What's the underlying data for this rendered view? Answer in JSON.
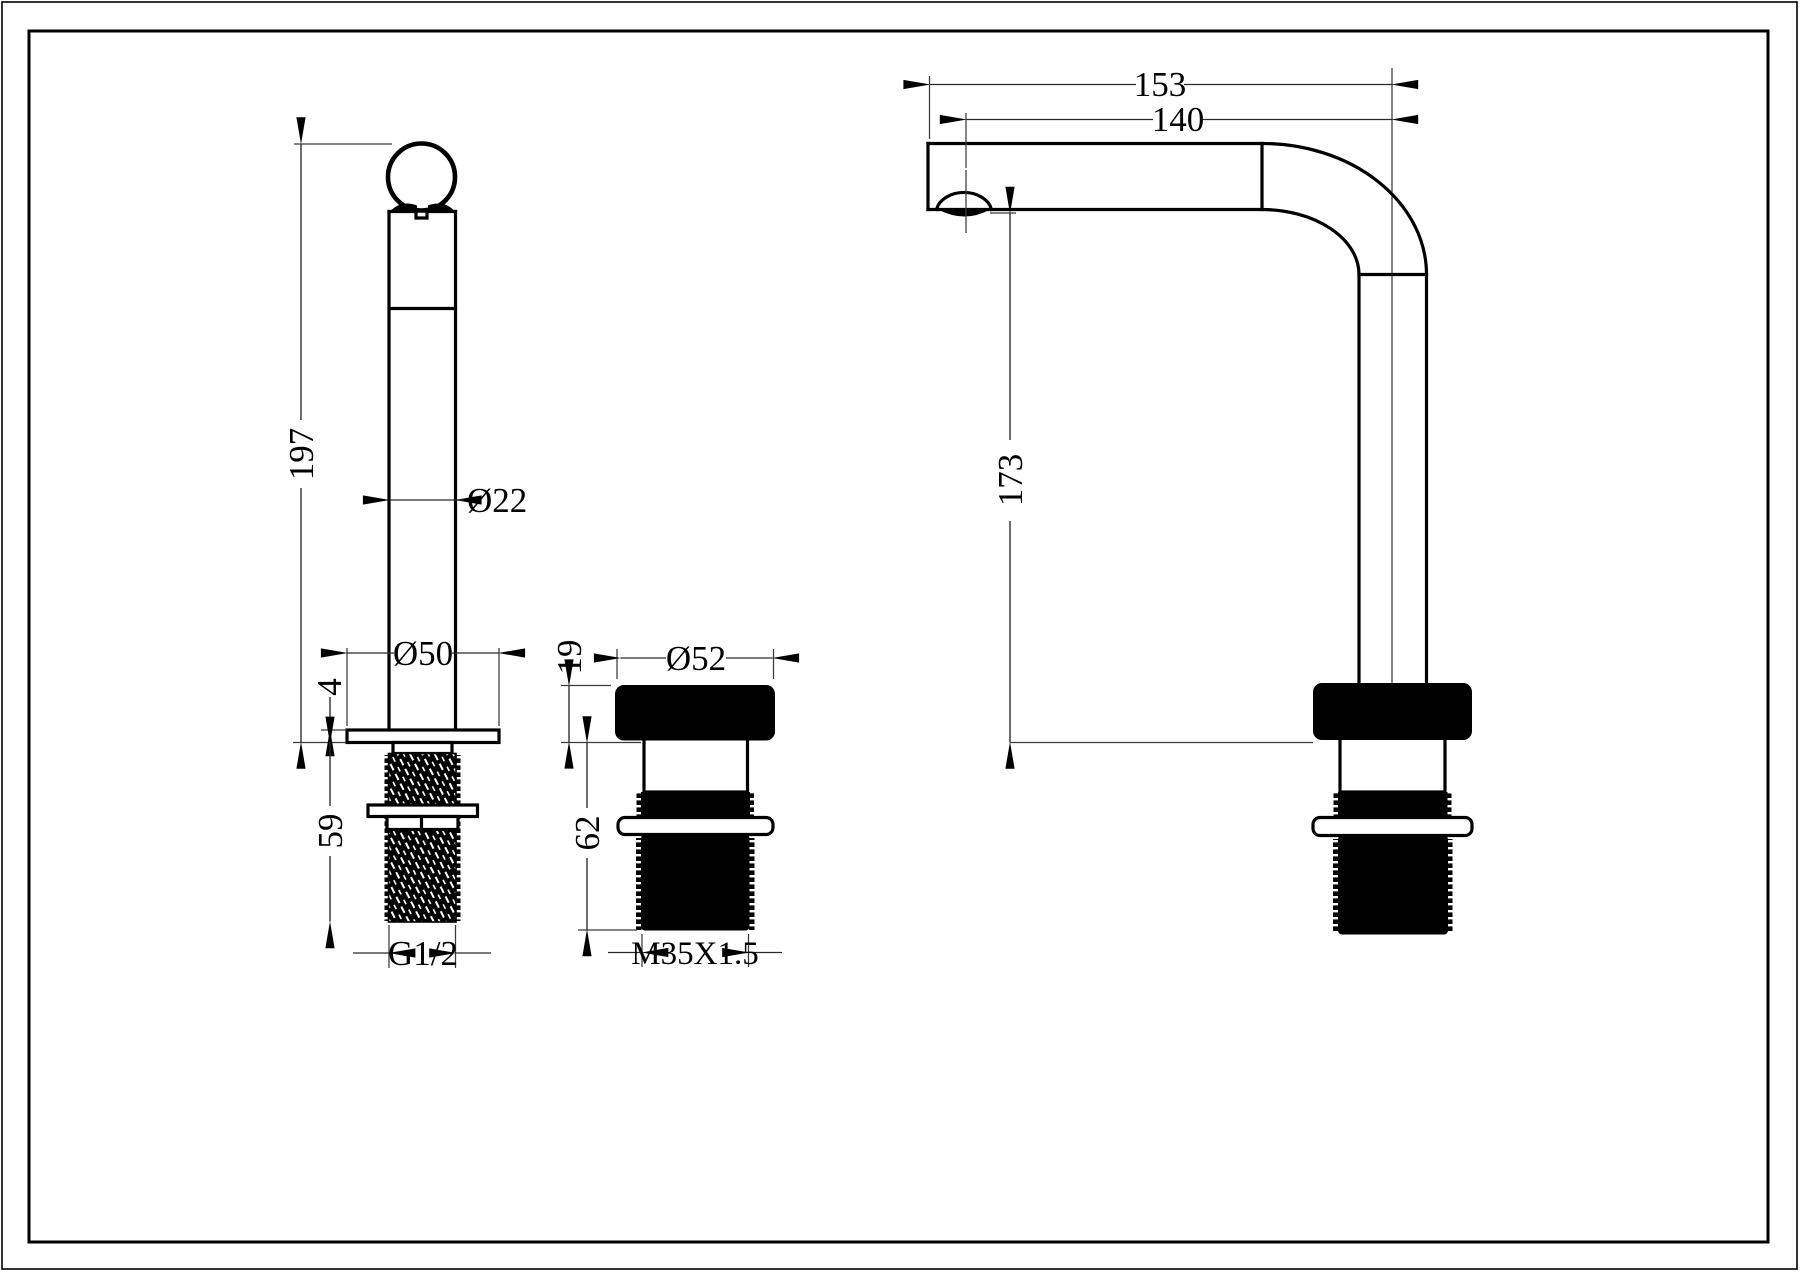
{
  "drawing": {
    "type": "technical-dimension-drawing",
    "subject": "basin faucet tap - three orthographic views",
    "line_color": "#000000",
    "background": "#ffffff",
    "views": {
      "handle": {
        "label": "handle / control stem side view",
        "overall_height": "197",
        "shaft_diameter": "Ø22",
        "base_diameter": "Ø50",
        "base_plate_thickness": "4",
        "thread_length": "59",
        "thread_spec": "G1/2"
      },
      "base": {
        "label": "mounting base front view",
        "cap_height": "19",
        "cap_diameter": "Ø52",
        "body_length": "62",
        "thread_spec": "M35X1.5"
      },
      "spout": {
        "label": "spout side view",
        "reach_overall": "153",
        "reach_to_outlet": "140",
        "outlet_height": "173"
      }
    }
  }
}
